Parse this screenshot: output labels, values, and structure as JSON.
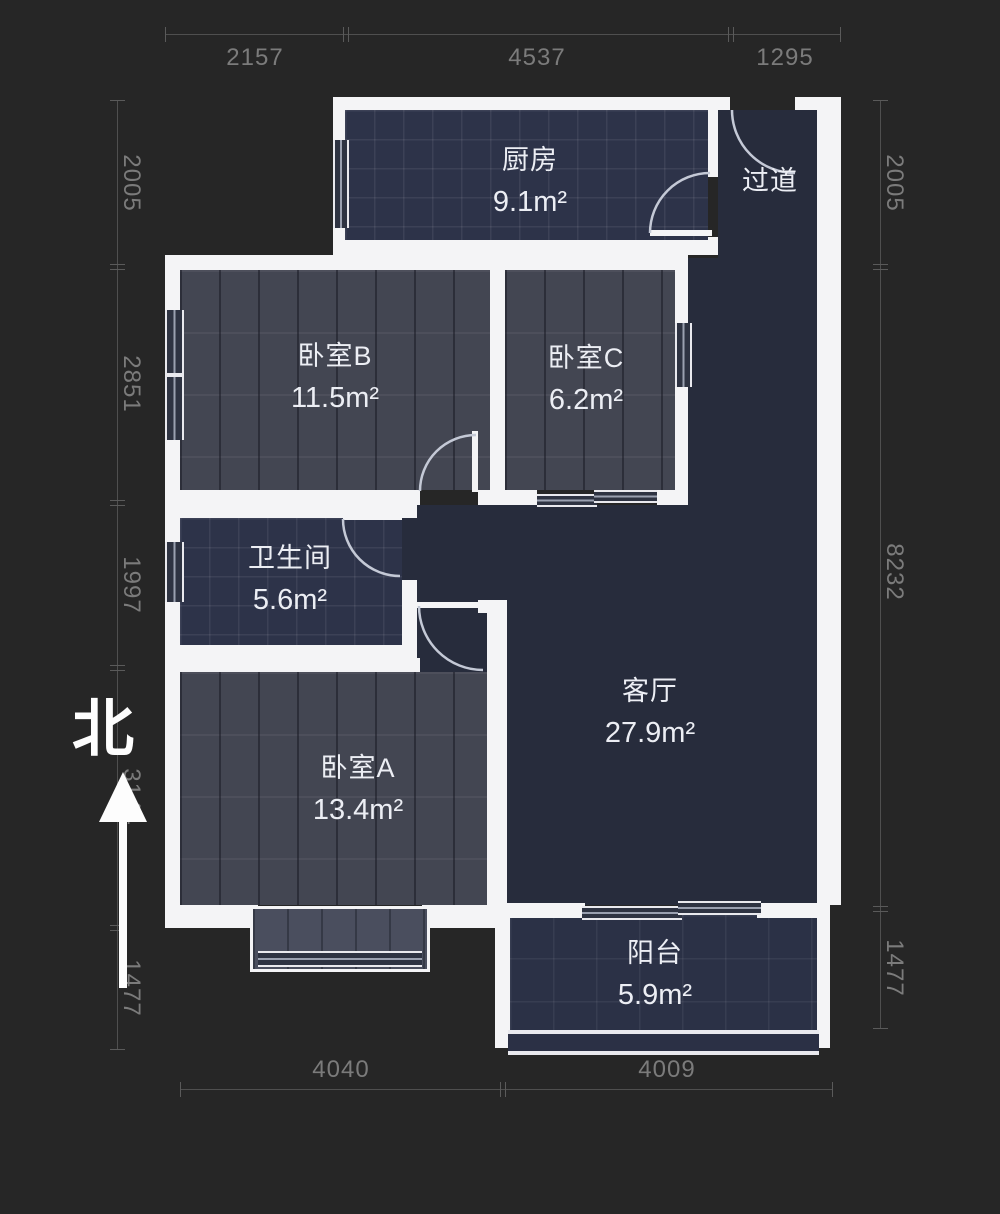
{
  "plan_type": "floor-plan",
  "compass": {
    "north_label": "北"
  },
  "rooms": {
    "kitchen": {
      "name": "厨房",
      "area": "9.1m²"
    },
    "hallway": {
      "name": "过道"
    },
    "bedroomB": {
      "name": "卧室B",
      "area": "11.5m²"
    },
    "bedroomC": {
      "name": "卧室C",
      "area": "6.2m²"
    },
    "bathroom": {
      "name": "卫生间",
      "area": "5.6m²"
    },
    "living": {
      "name": "客厅",
      "area": "27.9m²"
    },
    "bedroomA": {
      "name": "卧室A",
      "area": "13.4m²"
    },
    "balcony": {
      "name": "阳台",
      "area": "5.9m²"
    }
  },
  "dimensions_mm": {
    "top": [
      "2157",
      "4537",
      "1295"
    ],
    "left": [
      "2005",
      "2851",
      "1997",
      "3144",
      "1477"
    ],
    "right": [
      "2005",
      "8232",
      "1477"
    ],
    "bottom": [
      "4040",
      "4009"
    ]
  },
  "colors": {
    "background": "#262626",
    "wall": "#f4f4f6",
    "tile_floor": "#2d3349",
    "wood_floor": "#434652",
    "living_floor": "#272c3c",
    "dimension_text": "#7b7b7b",
    "label_text": "#eceef4"
  }
}
